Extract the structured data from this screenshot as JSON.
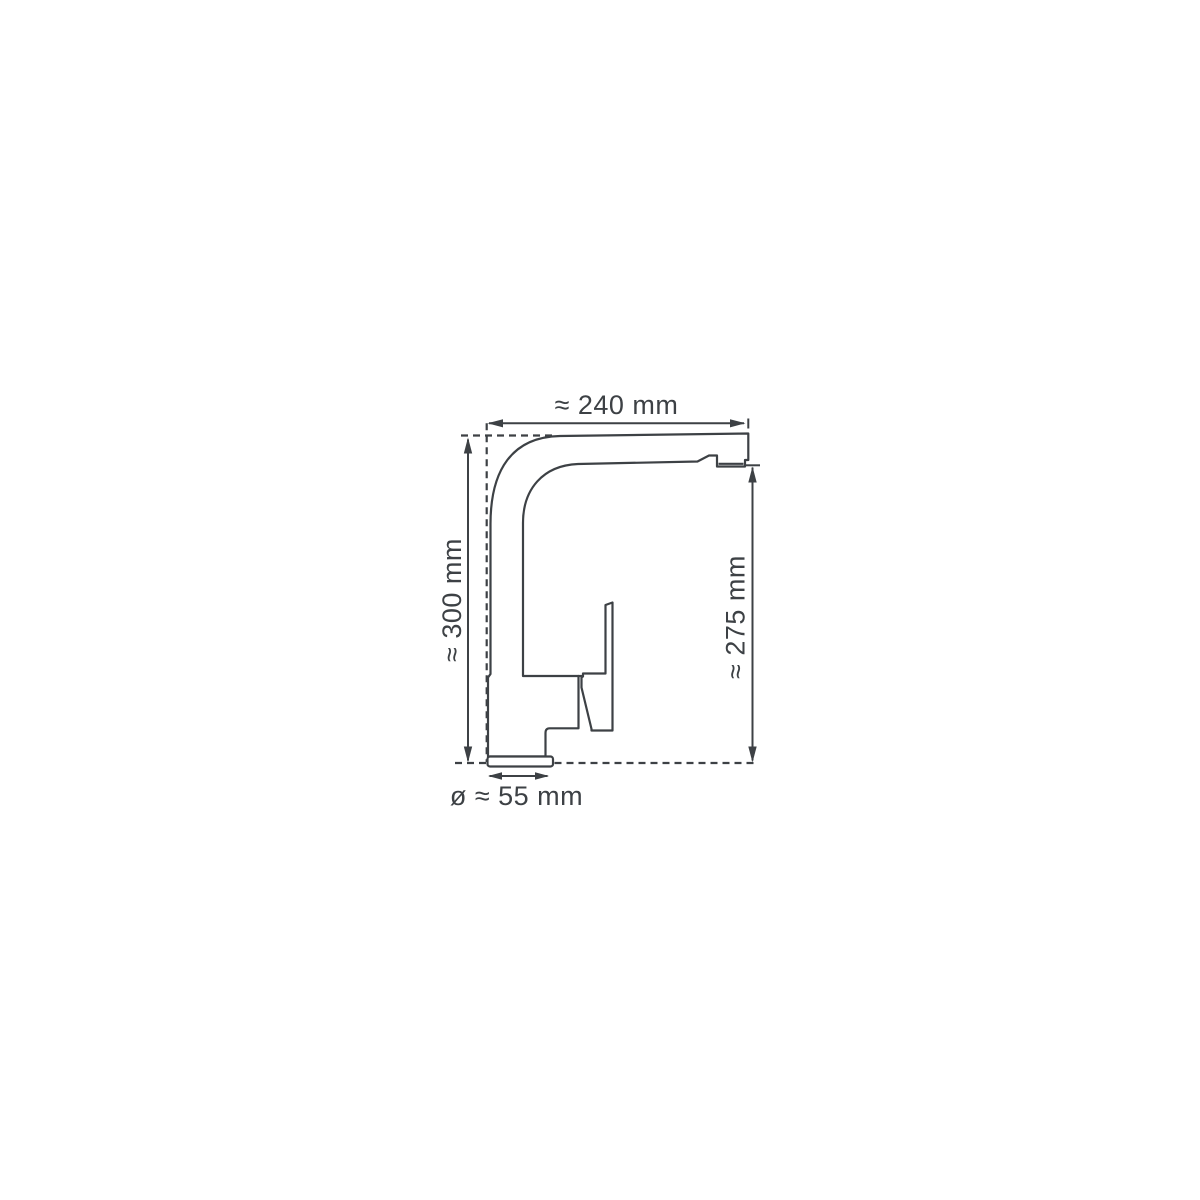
{
  "diagram": {
    "subject": "kitchen-faucet-side-view-dimension-drawing",
    "background_color": "#ffffff",
    "line_color": "#3d4145",
    "dimensions": {
      "spout_width": "≈ 240 mm",
      "total_height": "≈ 300 mm",
      "spout_outlet_height": "≈ 275 mm",
      "base_diameter": "ø ≈ 55 mm"
    }
  }
}
